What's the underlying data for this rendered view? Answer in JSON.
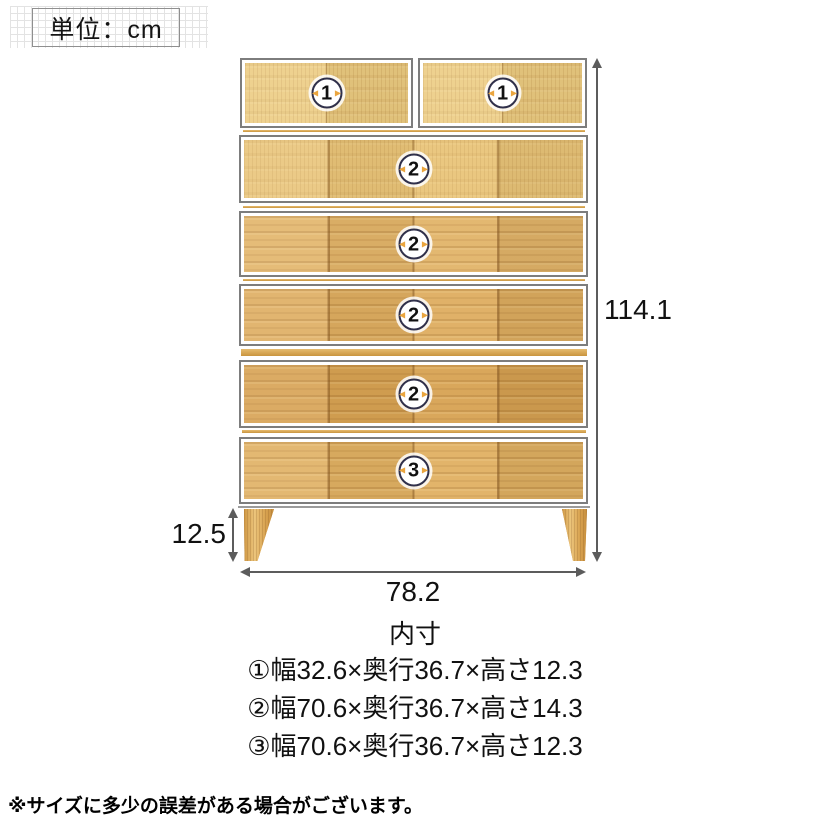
{
  "unit_label": "単位：cm",
  "icons": {
    "open_arrow_left": "◀",
    "open_arrow_right": "▶"
  },
  "diagram": {
    "drawers": [
      {
        "position": "row1-left",
        "badge": "1"
      },
      {
        "position": "row1-right",
        "badge": "1"
      },
      {
        "position": "row2",
        "badge": "2"
      },
      {
        "position": "row3",
        "badge": "2"
      },
      {
        "position": "row4",
        "badge": "2"
      },
      {
        "position": "row5",
        "badge": "2"
      },
      {
        "position": "row6",
        "badge": "3"
      }
    ],
    "dimensions": {
      "total_height_cm": "114.1",
      "leg_height_cm": "12.5",
      "total_width_cm": "78.2"
    }
  },
  "inner_dimensions": {
    "title": "内寸",
    "items": [
      {
        "text": "①幅32.6×奥行36.7×高さ12.3"
      },
      {
        "text": "②幅70.6×奥行36.7×高さ14.3"
      },
      {
        "text": "③幅70.6×奥行36.7×高さ12.3"
      }
    ]
  },
  "footnote": "※サイズに多少の誤差がある場合がございます。",
  "colors": {
    "wood_light": "#eccb80",
    "wood_medium": "#e2b469",
    "wood_dark": "#d7a252",
    "drawer_border": "#7d7d7d",
    "arrow": "#5c5c5c",
    "badge_ring": "#30304a",
    "badge_arrow_orange": "#eaa53e",
    "grid_line": "#e3e3e3"
  }
}
